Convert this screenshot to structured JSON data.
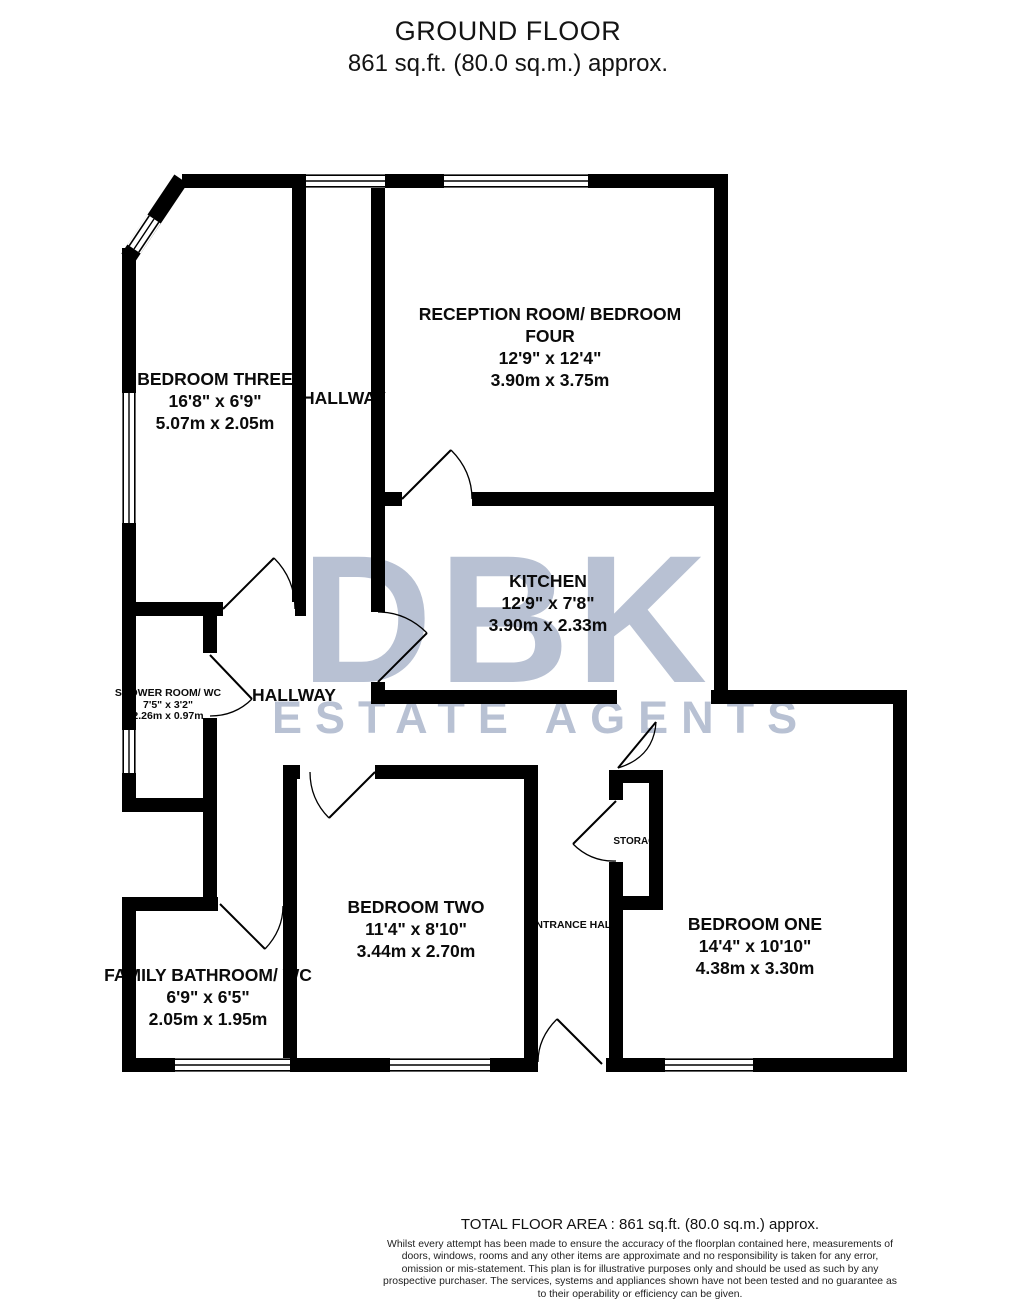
{
  "header": {
    "title": "GROUND FLOOR",
    "subtitle": "861 sq.ft. (80.0 sq.m.) approx."
  },
  "watermark": {
    "line1": "DBK",
    "line2": "ESTATE AGENTS",
    "color": "#b8c1d3"
  },
  "plan": {
    "wall_color": "#000000",
    "rooms": [
      {
        "id": "bedroom-three",
        "name": "BEDROOM THREE",
        "dims_imperial": "16'8\"  x 6'9\"",
        "dims_metric": "5.07m  x 2.05m"
      },
      {
        "id": "reception-room-bedroom-four",
        "name": "RECEPTION ROOM/ BEDROOM FOUR",
        "dims_imperial": "12'9\"  x 12'4\"",
        "dims_metric": "3.90m  x 3.75m"
      },
      {
        "id": "kitchen",
        "name": "KITCHEN",
        "dims_imperial": "12'9\"  x 7'8\"",
        "dims_metric": "3.90m  x 2.33m"
      },
      {
        "id": "shower-room-wc",
        "name": "SHOWER ROOM/ WC",
        "dims_imperial": "7'5\"  x 3'2\"",
        "dims_metric": "2.26m  x 0.97m"
      },
      {
        "id": "bedroom-two",
        "name": "BEDROOM TWO",
        "dims_imperial": "11'4\"  x 8'10\"",
        "dims_metric": "3.44m  x 2.70m"
      },
      {
        "id": "bedroom-one",
        "name": "BEDROOM ONE",
        "dims_imperial": "14'4\"  x 10'10\"",
        "dims_metric": "4.38m  x 3.30m"
      },
      {
        "id": "family-bathroom-wc",
        "name": "FAMILY BATHROOM/ WC",
        "dims_imperial": "6'9\"  x 6'5\"",
        "dims_metric": "2.05m  x 1.95m"
      }
    ],
    "areas": {
      "hallway_upper": "HALLWAY",
      "hallway_lower": "HALLWAY",
      "entrance_hall": "ENTRANCE HALL",
      "storage": "STORAGE"
    }
  },
  "footer": {
    "total_area": "TOTAL FLOOR AREA : 861 sq.ft. (80.0 sq.m.) approx.",
    "disclaimer": "Whilst every attempt has been made to ensure the accuracy of the floorplan contained here, measurements of doors, windows, rooms and any other items are approximate and no responsibility is taken for any error, omission or mis-statement. This plan is for illustrative purposes only and should be used as such by any prospective purchaser. The services, systems and appliances shown have not been tested and no guarantee as to their operability or efficiency can be given.",
    "credit": "Made with Metropix ©2026"
  }
}
